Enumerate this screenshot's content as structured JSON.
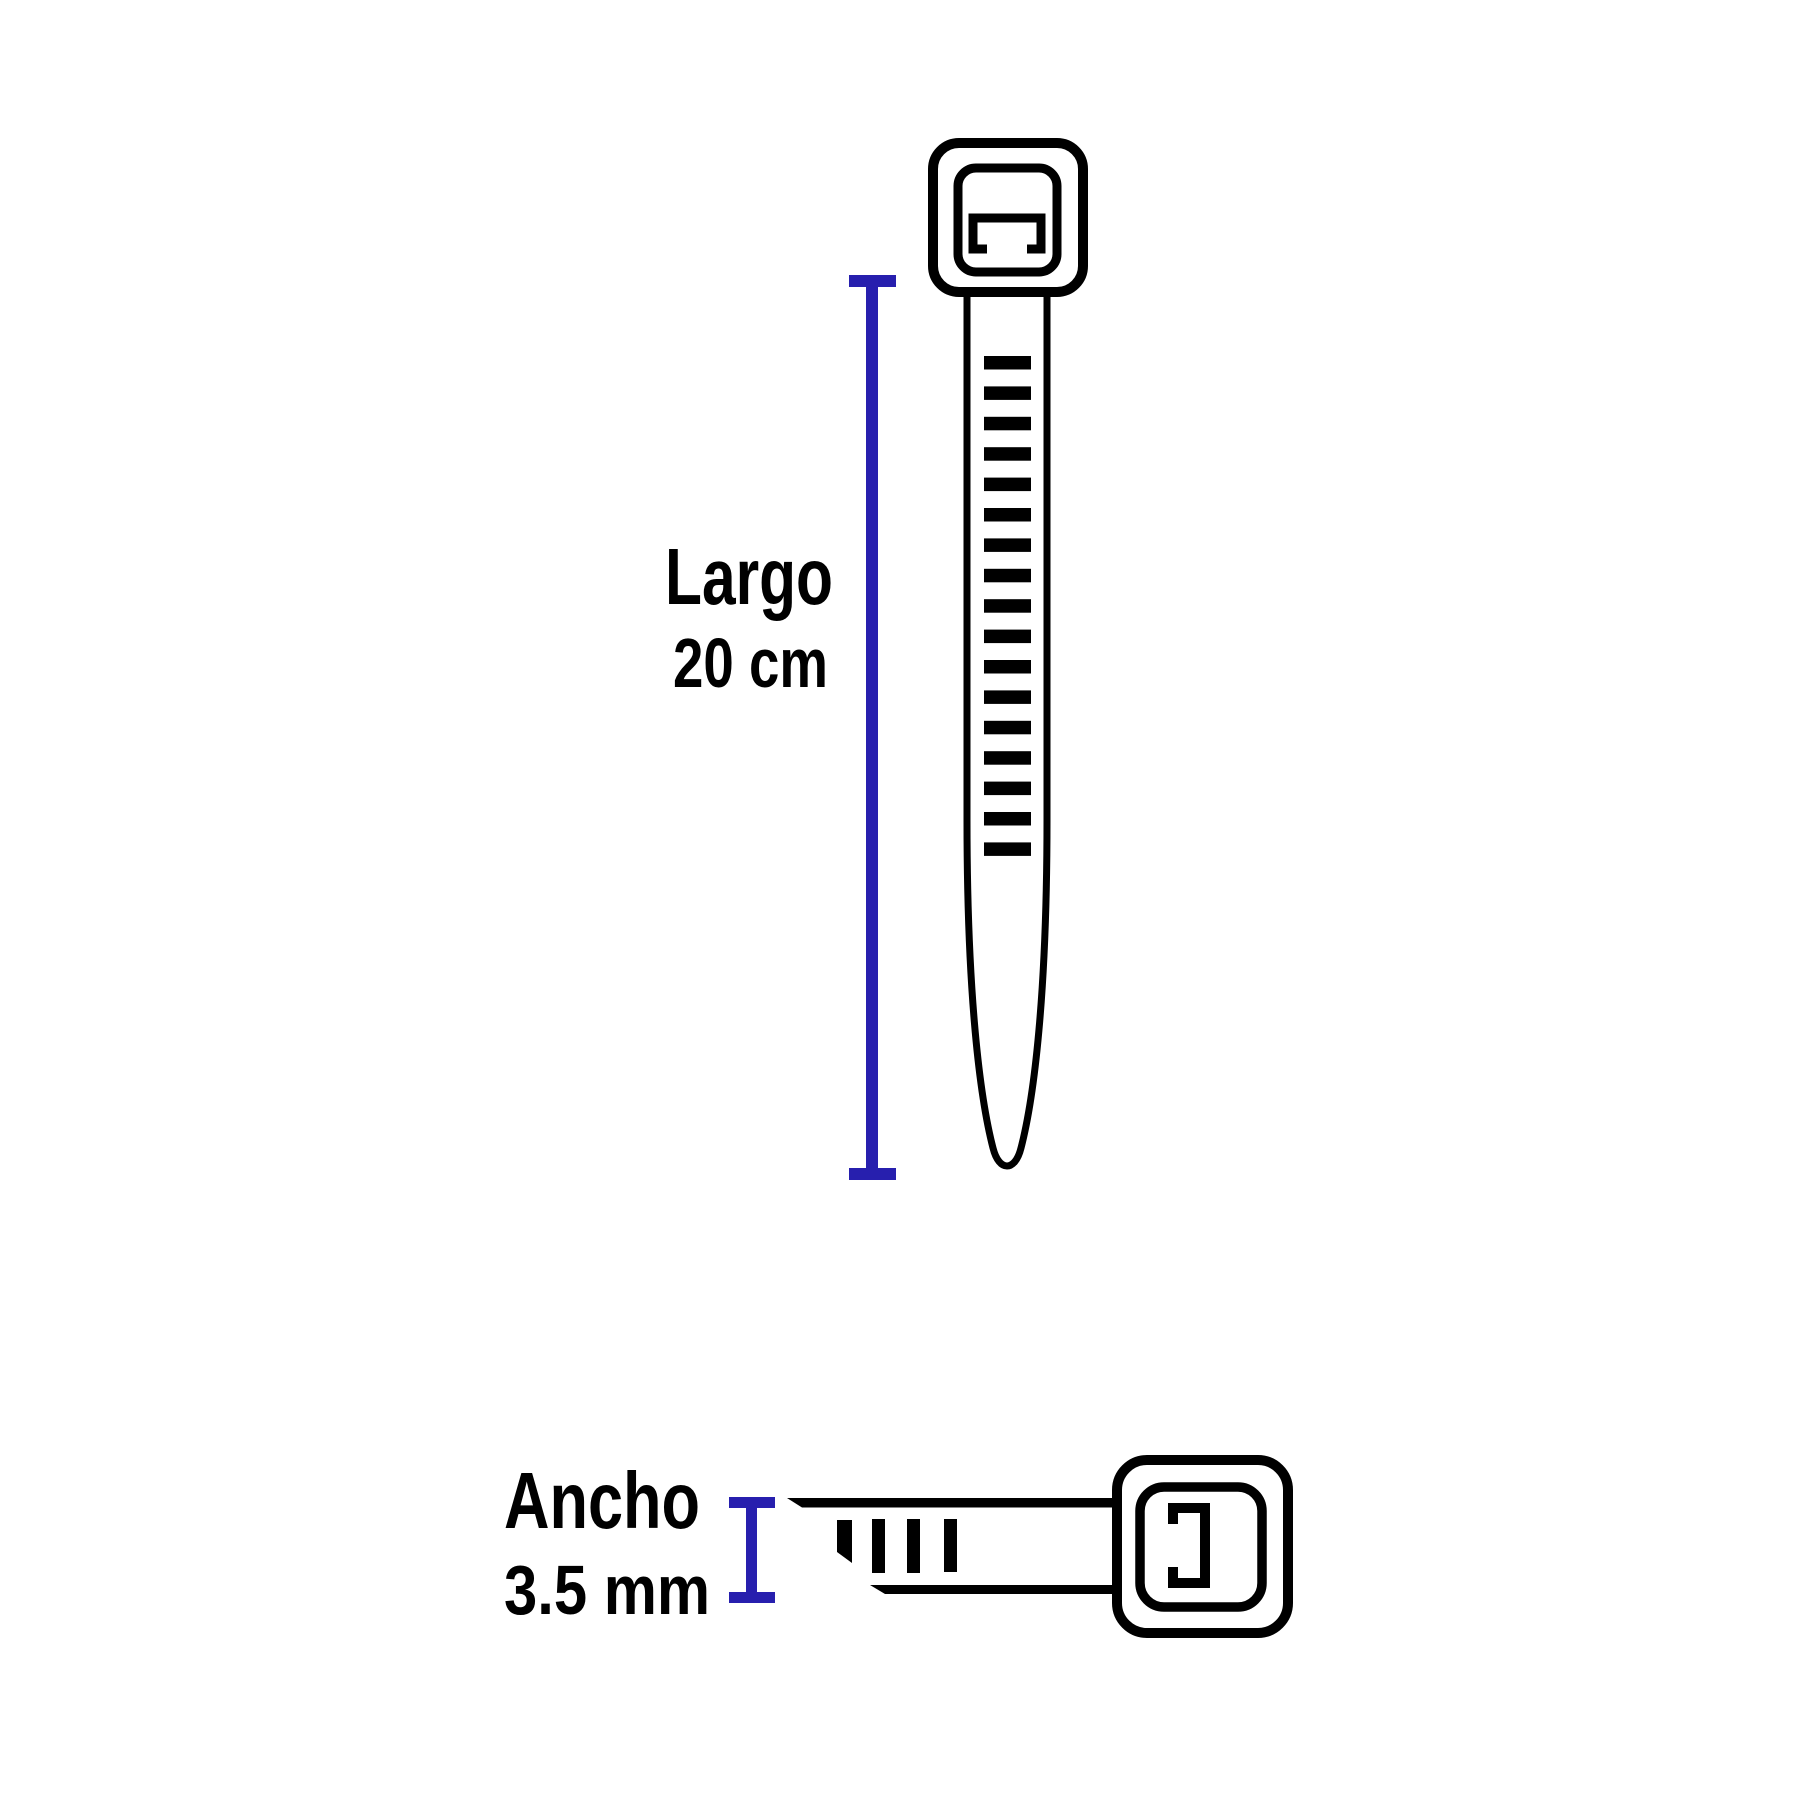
{
  "diagram": {
    "subject": "cable-tie-dimension-diagram",
    "background": "#ffffff",
    "colors": {
      "ink": "#000000",
      "dimension_blue": "#271fae"
    },
    "length_dimension": {
      "label": "Largo",
      "value": "20 cm"
    },
    "width_dimension": {
      "label": "Ancho",
      "value": "3.5 mm"
    },
    "icons": [
      "cable-tie-top-view",
      "cable-tie-side-view",
      "dimension-line-vertical",
      "dimension-line-width"
    ]
  }
}
